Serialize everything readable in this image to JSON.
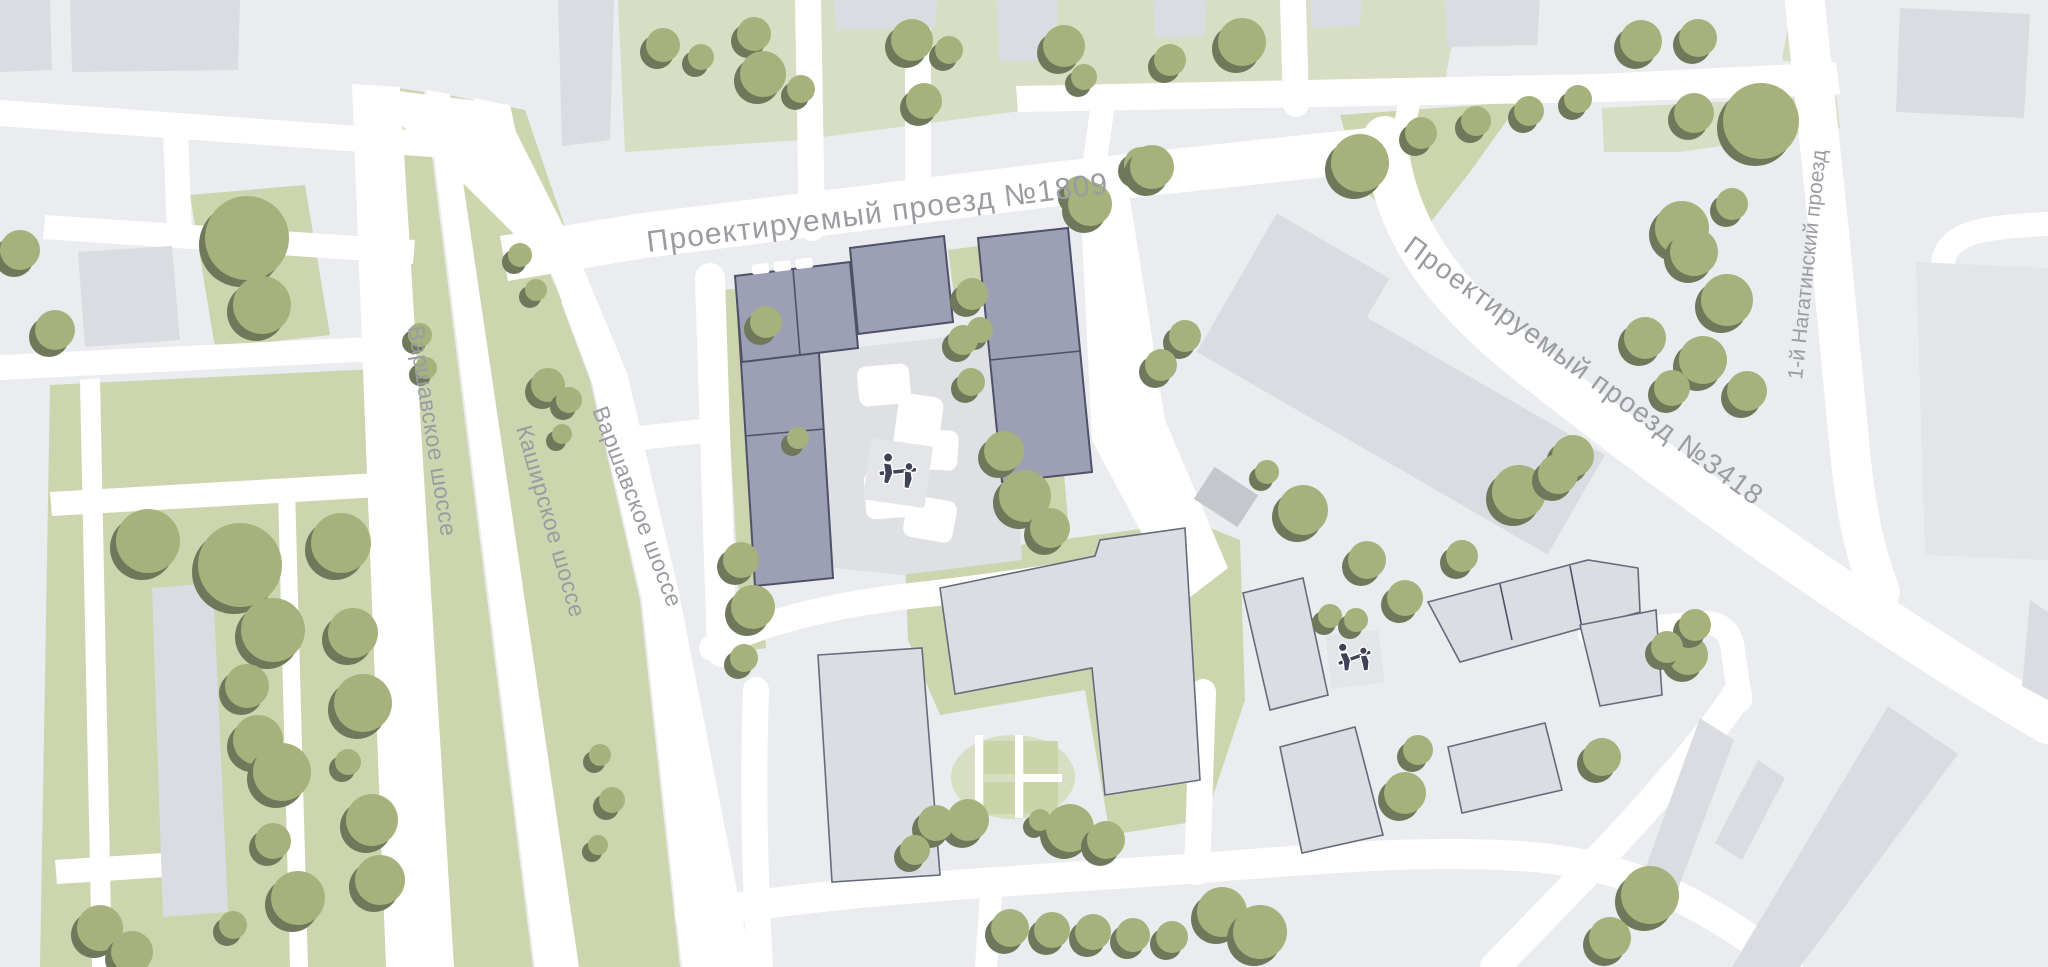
{
  "map": {
    "type": "architectural site plan",
    "street_labels": [
      {
        "id": "proezd-1809",
        "text": "Проектируемый проезд №1809"
      },
      {
        "id": "proezd-3418",
        "text": "Проектируемый проезд №3418"
      },
      {
        "id": "nagatinsky",
        "text": "1-й Нагатинский проезд"
      },
      {
        "id": "varshavskoe-1",
        "text": "Варшавское шоссе"
      },
      {
        "id": "kashirskoe",
        "text": "Каширское шоссе"
      },
      {
        "id": "varshavskoe-2",
        "text": "Варшавское шоссе"
      }
    ],
    "icons": {
      "playground": "playground-icon",
      "tree": "tree-icon"
    },
    "colors": {
      "background": "#EAECF0",
      "road": "#FFFFFF",
      "green": "#CCD5AE",
      "green_light": "#D7DEC3",
      "tree": "#A6B17C",
      "tree_shadow": "#6F785A",
      "building": "#DADCE1",
      "building_outline": "#666B7C",
      "building_highlight": "#9DA0B4",
      "building_highlight_outline": "#4E5268",
      "courtyard_paving": "#DEE0E4",
      "utility_box": "#C5C7CC",
      "label_text": "#9A9CA2"
    }
  }
}
